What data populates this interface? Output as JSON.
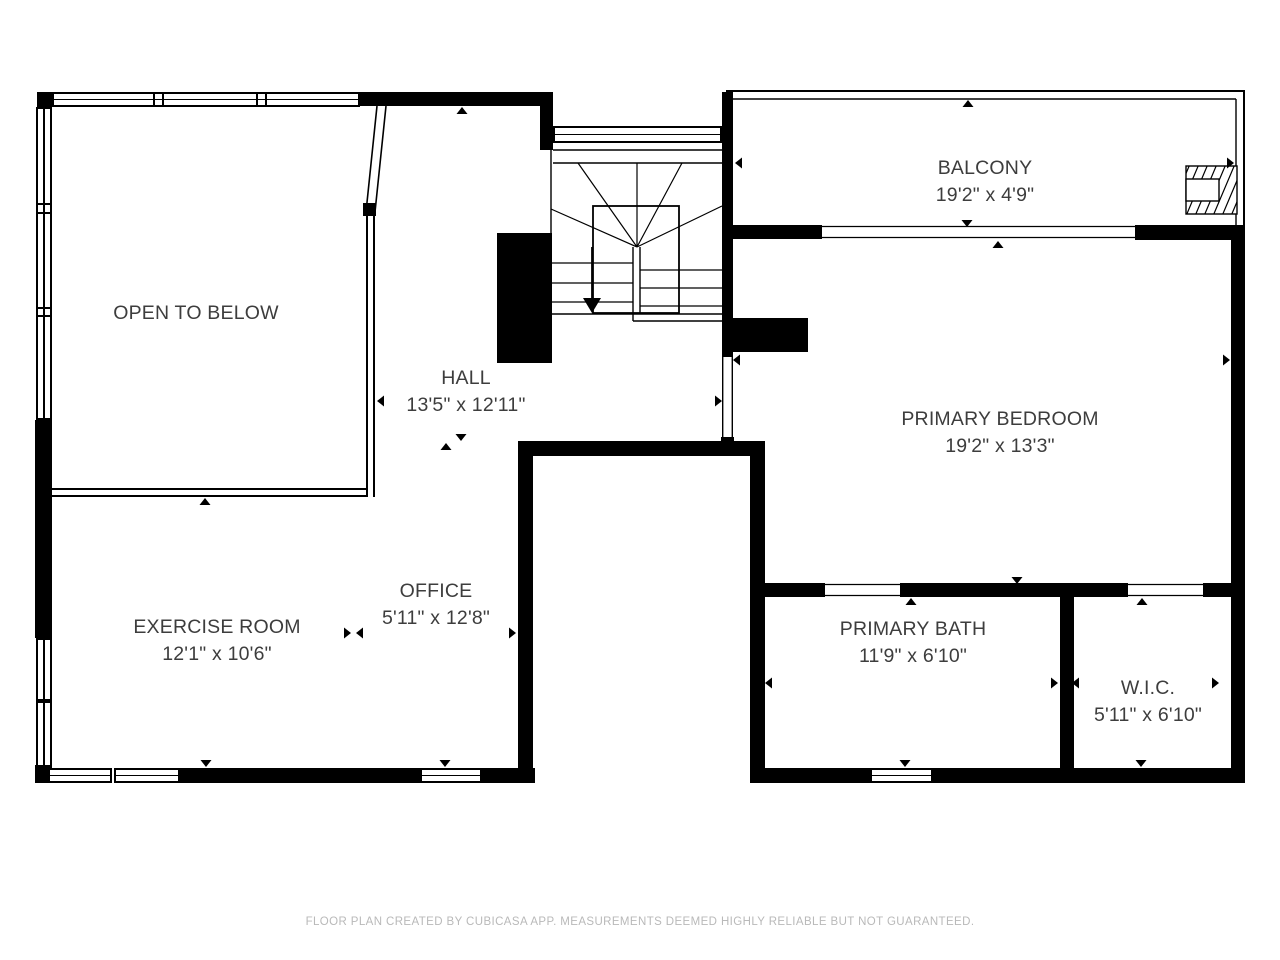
{
  "plan": {
    "type": "floor-plan",
    "floor": "second-floor",
    "colors": {
      "wall": "#000000",
      "background": "#ffffff",
      "label_text": "#3d3d3d",
      "footer_text": "#b9b9b9"
    },
    "rooms": {
      "open_to_below": {
        "name": "OPEN TO BELOW",
        "dims": ""
      },
      "balcony": {
        "name": "BALCONY",
        "dims": "19'2\" x 4'9\""
      },
      "hall": {
        "name": "HALL",
        "dims": "13'5\" x 12'11\""
      },
      "primary_bedroom": {
        "name": "PRIMARY BEDROOM",
        "dims": "19'2\" x 13'3\""
      },
      "exercise_room": {
        "name": "EXERCISE ROOM",
        "dims": "12'1\" x 10'6\""
      },
      "office": {
        "name": "OFFICE",
        "dims": "5'11\" x 12'8\""
      },
      "primary_bath": {
        "name": "PRIMARY BATH",
        "dims": "11'9\" x 6'10\""
      },
      "wic": {
        "name": "W.I.C.",
        "dims": "5'11\" x 6'10\""
      }
    },
    "stairs": {
      "direction": "down"
    }
  },
  "footer": {
    "disclaimer": "FLOOR PLAN CREATED BY CUBICASA APP. MEASUREMENTS DEEMED HIGHLY RELIABLE BUT NOT GUARANTEED."
  }
}
